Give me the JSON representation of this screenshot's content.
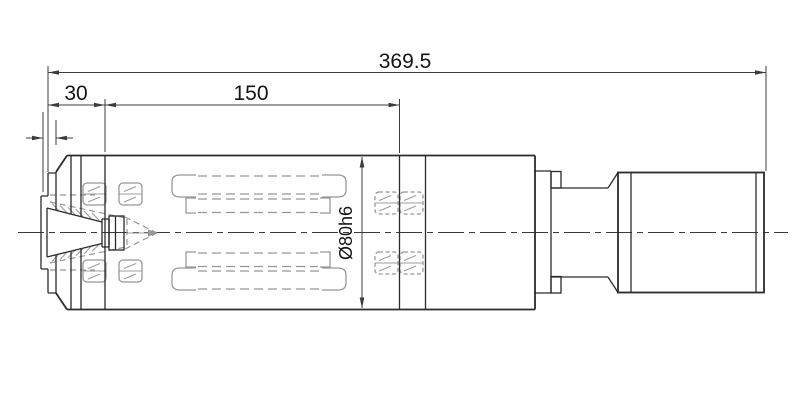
{
  "drawing": {
    "type": "engineering-cad-drawing",
    "subject": "motor-spindle-side-section-view",
    "dimensions": {
      "overall_length": "369.5",
      "front_section_length": "30",
      "body_length": "150",
      "body_diameter": "Ø80h6"
    },
    "colors": {
      "outline": "#2b2b2b",
      "hidden_detail": "#979797",
      "dimension": "#3c3c3c",
      "background": "#ffffff"
    },
    "line_styles": {
      "centerline": "dash-dot",
      "hidden_components": "dashed-gray",
      "visible_edges": "solid-black"
    }
  }
}
